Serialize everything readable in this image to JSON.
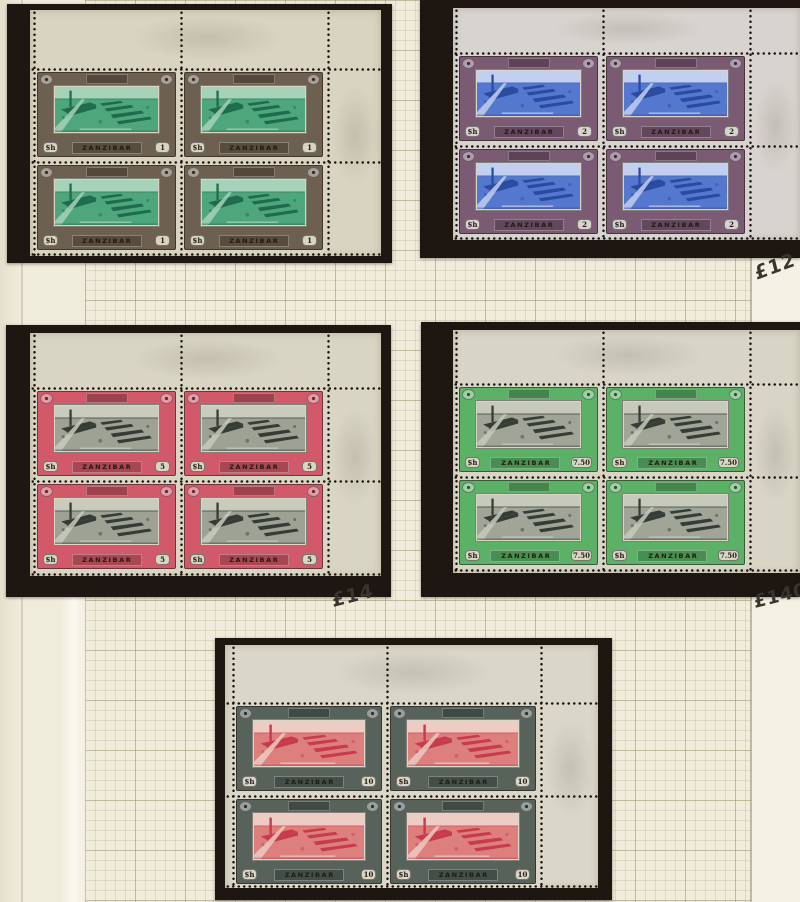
{
  "page": {
    "background": "#efecdc",
    "left_margin_shade": "#e4e0cd",
    "right_strip_color": "#f3f0e4",
    "right_strip_x": 751,
    "grid": {
      "left": 85,
      "right": 751,
      "minor_step": 10,
      "major_step": 50,
      "minor_color": "rgba(172,160,120,0.26)",
      "major_color": "rgba(150,138,96,0.38)"
    },
    "edge_lines": [
      {
        "x": 21,
        "color": "rgba(150,140,112,0.30)"
      },
      {
        "x": 750,
        "color": "rgba(148,138,108,0.55)"
      }
    ]
  },
  "stamp_text": {
    "country": "ZANZIBAR",
    "currency": "$h"
  },
  "card_color": "#1d1611",
  "blocks": [
    {
      "id": "1s",
      "value": "1",
      "card": {
        "x": 7,
        "y": 4,
        "w": 385,
        "h": 259
      },
      "paper": {
        "x": 30,
        "y": 10,
        "w": 351,
        "h": 246
      },
      "cols": [
        33,
        180,
        327
      ],
      "rows": [
        68,
        161,
        254
      ],
      "colors": {
        "paper": "#d8d4c1",
        "frame": "#6e6050",
        "sky": "#a6d2ba",
        "mid": "#4ea77c",
        "dark": "#1f6b4d"
      }
    },
    {
      "id": "2s",
      "value": "2",
      "card": {
        "x": 420,
        "y": 0,
        "w": 380,
        "h": 258
      },
      "paper": {
        "x": 453,
        "y": 8,
        "w": 347,
        "h": 232
      },
      "cols": [
        455,
        602,
        749
      ],
      "rows": [
        52,
        145,
        238
      ],
      "colors": {
        "paper": "#d7d3ce",
        "frame": "#7b5a73",
        "sky": "#c2cfee",
        "mid": "#5578cf",
        "dark": "#2b4aa2"
      }
    },
    {
      "id": "5s",
      "value": "5",
      "card": {
        "x": 6,
        "y": 325,
        "w": 385,
        "h": 272
      },
      "paper": {
        "x": 30,
        "y": 333,
        "w": 351,
        "h": 243
      },
      "cols": [
        33,
        180,
        327
      ],
      "rows": [
        387,
        480,
        573
      ],
      "colors": {
        "paper": "#d9d5c4",
        "frame": "#d2596a",
        "sky": "#c9cbbd",
        "mid": "#9da295",
        "dark": "#343c35"
      }
    },
    {
      "id": "7s50",
      "value": "7.50",
      "card": {
        "x": 421,
        "y": 322,
        "w": 379,
        "h": 275
      },
      "paper": {
        "x": 453,
        "y": 330,
        "w": 347,
        "h": 243
      },
      "cols": [
        455,
        602,
        749
      ],
      "rows": [
        383,
        476,
        569
      ],
      "colors": {
        "paper": "#d8d5c6",
        "frame": "#5bb267",
        "sky": "#c7cabb",
        "mid": "#a0a598",
        "dark": "#353d37"
      }
    },
    {
      "id": "10s",
      "value": "10",
      "card": {
        "x": 215,
        "y": 638,
        "w": 397,
        "h": 262
      },
      "paper": {
        "x": 225,
        "y": 645,
        "w": 373,
        "h": 243
      },
      "cols": [
        232,
        386,
        540
      ],
      "rows": [
        702,
        795,
        888
      ],
      "colors": {
        "paper": "#dad7c8",
        "frame": "#56625a",
        "sky": "#ecccc3",
        "mid": "#dd807d",
        "dark": "#c63c4d"
      }
    }
  ],
  "annotations": [
    {
      "text": "£12",
      "x": 755,
      "y": 263,
      "rot": -20,
      "size": 19
    },
    {
      "text": "£14",
      "x": 332,
      "y": 590,
      "rot": -14,
      "size": 19
    },
    {
      "text": "£140",
      "x": 754,
      "y": 592,
      "rot": -14,
      "size": 18
    }
  ]
}
